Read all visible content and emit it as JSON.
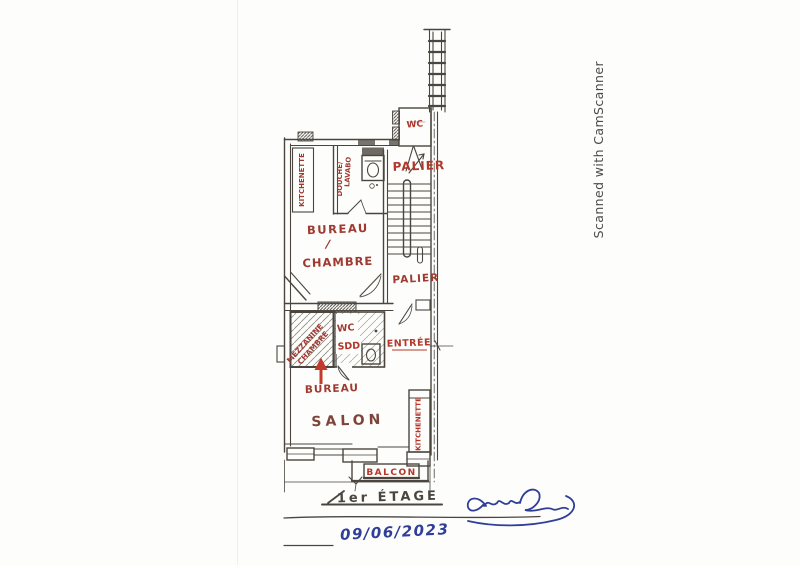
{
  "watermark": {
    "text": "Scanned with CamScanner"
  },
  "floorplan": {
    "labels": {
      "kitchenette_top": "KITCHENETTE",
      "douche": "DOUCHE/",
      "lavabo": "LAVABO",
      "wc_upper": "WC",
      "palier_upper": "PALIER",
      "bureau": "BUREAU",
      "slash": "/",
      "chambre": "CHAMBRE",
      "palier_lower": "PALIER",
      "mezzanine_line1": "MEZZANINE",
      "mezzanine_line2": "CHAMBRE",
      "wc_lower": "WC",
      "sdd": "SDD",
      "entree": "ENTRÉE",
      "bureau_pointer": "BUREAU",
      "salon": "SALON",
      "kitchenette_right": "KITCHENETTE",
      "balcon": "BALCON"
    },
    "annotations": {
      "floor_title": "1er ÉTAGE",
      "date": "09/06/2023"
    },
    "colors": {
      "ink": "#4a463f",
      "label_red": "#9e3a31",
      "label_bright": "#b3362b",
      "label_dark": "#7e443a",
      "pen_blue": "#2f3e99",
      "watermark": "#4b4b4b",
      "paper": "#fdfdfb"
    }
  }
}
